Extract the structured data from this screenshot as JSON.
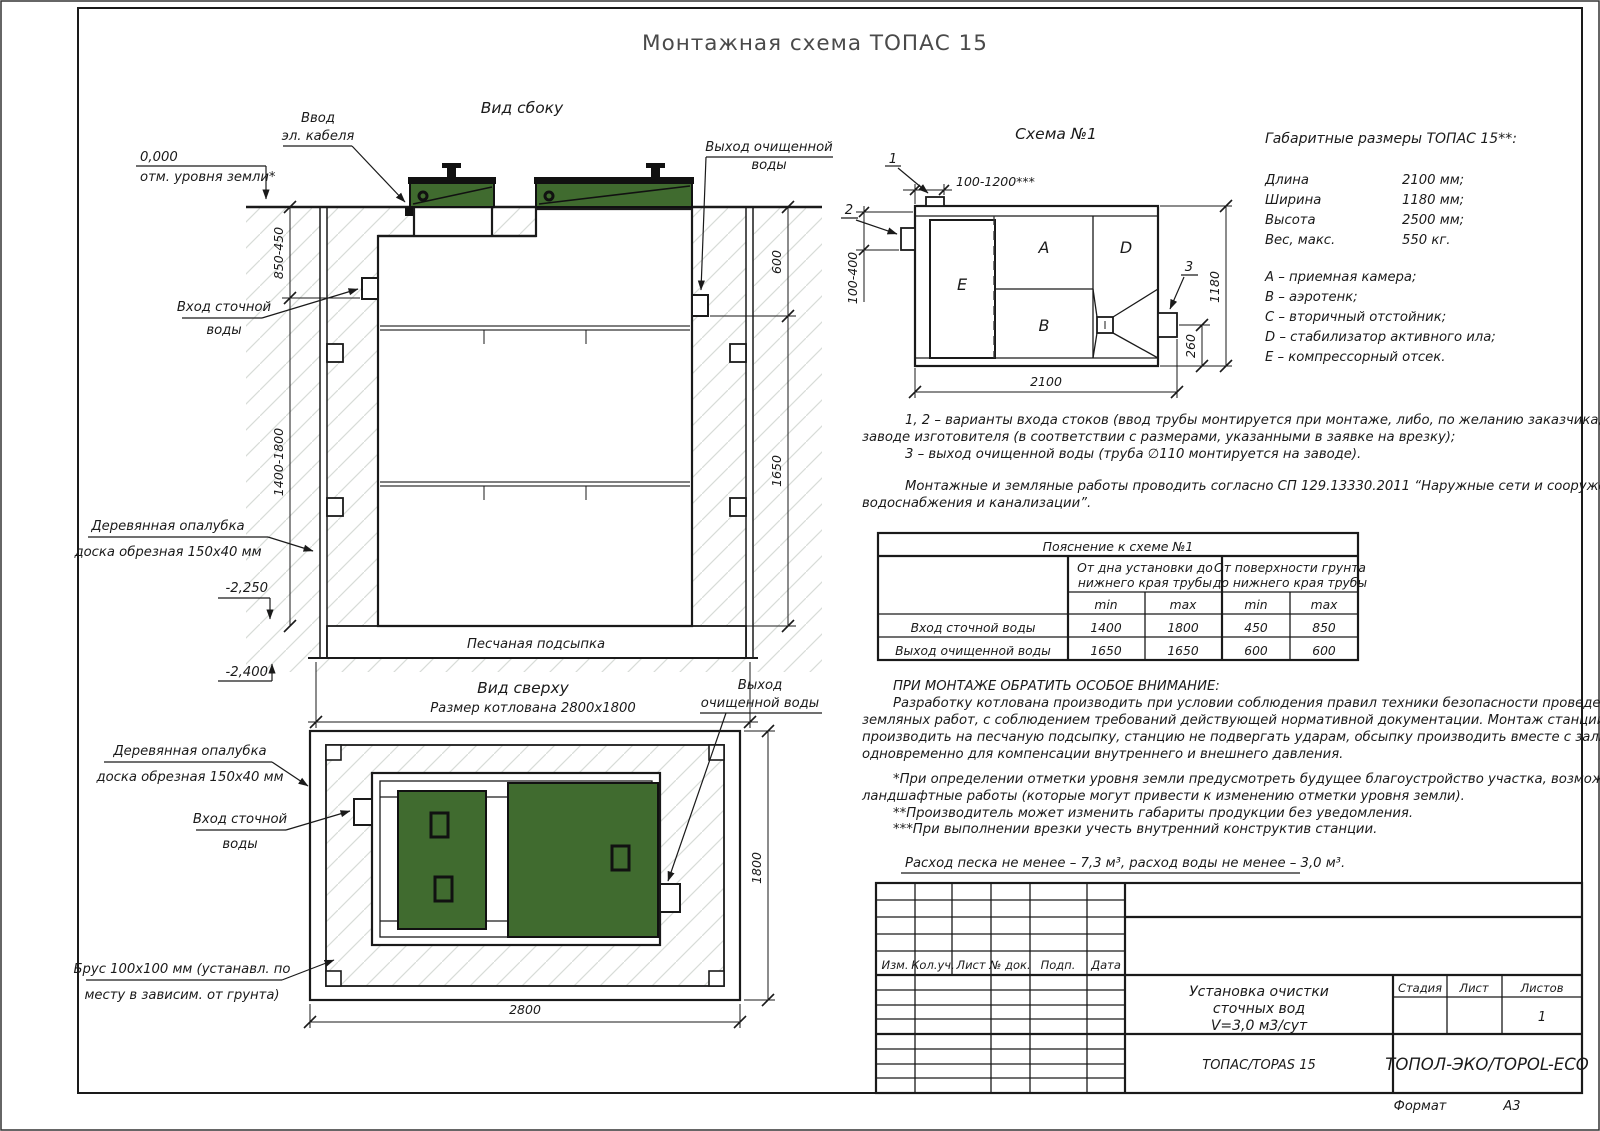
{
  "page_title": "Монтажная схема ТОПАС 15",
  "colors": {
    "lid_green": "#406b2f",
    "line": "#1a1a1a",
    "hatch": "#d7dbd7"
  },
  "side_view": {
    "title": "Вид сбоку",
    "labels": {
      "cable_line1": "Ввод",
      "cable_line2": "эл. кабеля",
      "outlet_line1": "Выход очищенной",
      "outlet_line2": "воды",
      "ground_elev": "0,000",
      "ground_note": "отм. уровня земли*",
      "inlet_line1": "Вход сточной",
      "inlet_line2": "воды",
      "formwork_line1": "Деревянная опалубка",
      "formwork_line2": "доска обрезная 150х40 мм",
      "sand": "Песчаная подсыпка",
      "pit_size": "Размер котлована 2800х1800",
      "elev_minus2250": "-2,250",
      "elev_minus2400": "-2,400"
    },
    "dims": {
      "d850": "850-450",
      "d1400": "1400-1800",
      "d600": "600",
      "d1650": "1650"
    }
  },
  "top_view": {
    "title": "Вид сверху",
    "labels": {
      "outlet_line1": "Выход",
      "outlet_line2": "очищенной воды",
      "formwork_line1": "Деревянная опалубка",
      "formwork_line2": "доска обрезная 150х40 мм",
      "inlet_line1": "Вход сточной",
      "inlet_line2": "воды",
      "brus_line1": "Брус 100х100 мм (устанавл. по",
      "brus_line2": "месту в зависим. от грунта)"
    },
    "dims": {
      "width": "2800",
      "depth": "1800"
    }
  },
  "schema": {
    "title": "Схема №1",
    "compartments": {
      "a": "A",
      "b": "B",
      "d": "D",
      "e": "E"
    },
    "markers": {
      "m1": "1",
      "m2": "2",
      "m3": "3"
    },
    "dims": {
      "top": "100-1200***",
      "left": "100-400",
      "height": "1180",
      "outlet": "260",
      "length": "2100"
    }
  },
  "specs": {
    "heading": "Габаритные размеры ТОПАС 15**:",
    "rows": [
      {
        "label": "Длина",
        "value": "2100 мм;"
      },
      {
        "label": "Ширина",
        "value": "1180 мм;"
      },
      {
        "label": "Высота",
        "value": "2500 мм;"
      },
      {
        "label": "Вес, макс.",
        "value": "550 кг."
      }
    ],
    "legend": [
      "А – приемная камера;",
      "В – аэротенк;",
      "С – вторичный отстойник;",
      "D – стабилизатор активного ила;",
      "Е – компрессорный отсек."
    ]
  },
  "notes": {
    "line1": "1, 2 – варианты входа стоков (ввод трубы монтируется при монтаже, либо, по желанию заказчика, на",
    "line2": "заводе изготовителя (в соответствии с размерами, указанными в заявке на врезку);",
    "line3": "3 – выход очищенной воды (труба ∅110 монтируется на заводе).",
    "sp_line1": "Монтажные и земляные работы проводить согласно СП 129.13330.2011 “Наружные сети и сооружения",
    "sp_line2": "водоснабжения и канализации”."
  },
  "table": {
    "title": "Пояснение к схеме №1",
    "group1_line1": "От дна установки до",
    "group1_line2": "нижнего края трубы",
    "group2_line1": "От поверхности грунта",
    "group2_line2": "до нижнего края трубы",
    "min": "min",
    "max": "max",
    "rows": [
      {
        "label": "Вход сточной воды",
        "v": [
          "1400",
          "1800",
          "450",
          "850"
        ]
      },
      {
        "label": "Выход очищенной воды",
        "v": [
          "1650",
          "1650",
          "600",
          "600"
        ]
      }
    ]
  },
  "attention": {
    "heading": "ПРИ МОНТАЖЕ ОБРАТИТЬ ОСОБОЕ ВНИМАНИЕ:",
    "p1": [
      "Разработку котлована производить при условии соблюдения правил техники безопасности проведения",
      "земляных работ, с соблюдением требований действующей нормативной документации. Монтаж станции",
      "производить на песчаную подсыпку, станцию не подвергать ударам, обсыпку производить вместе с заливкой",
      "одновременно для компенсации внутреннего и внешнего давления."
    ],
    "fn": [
      "*При определении отметки уровня земли предусмотреть будущее благоустройство участка, возможные",
      "ландшафтные работы (которые могут привести к изменению отметки уровня земли).",
      "**Производитель может изменить габариты продукции без уведомления.",
      "***При выполнении врезки учесть внутренний конструктив станции."
    ],
    "consumption": "Расход песка не менее – 7,3 м³, расход воды не менее – 3,0 м³."
  },
  "titleblock": {
    "cols": [
      "Изм.",
      "Кол.уч.",
      "Лист",
      "№ док.",
      "Подп.",
      "Дата"
    ],
    "product": [
      "Установка очистки",
      "сточных вод",
      "V=3,0 м3/сут"
    ],
    "model": "ТОПАС/TOPAS 15",
    "stage": "Стадия",
    "sheet": "Лист",
    "sheets": "Листов",
    "sheets_value": "1",
    "company": "ТОПОЛ-ЭКО/TOPOL-ECO",
    "format_label": "Формат",
    "format_value": "А3"
  }
}
